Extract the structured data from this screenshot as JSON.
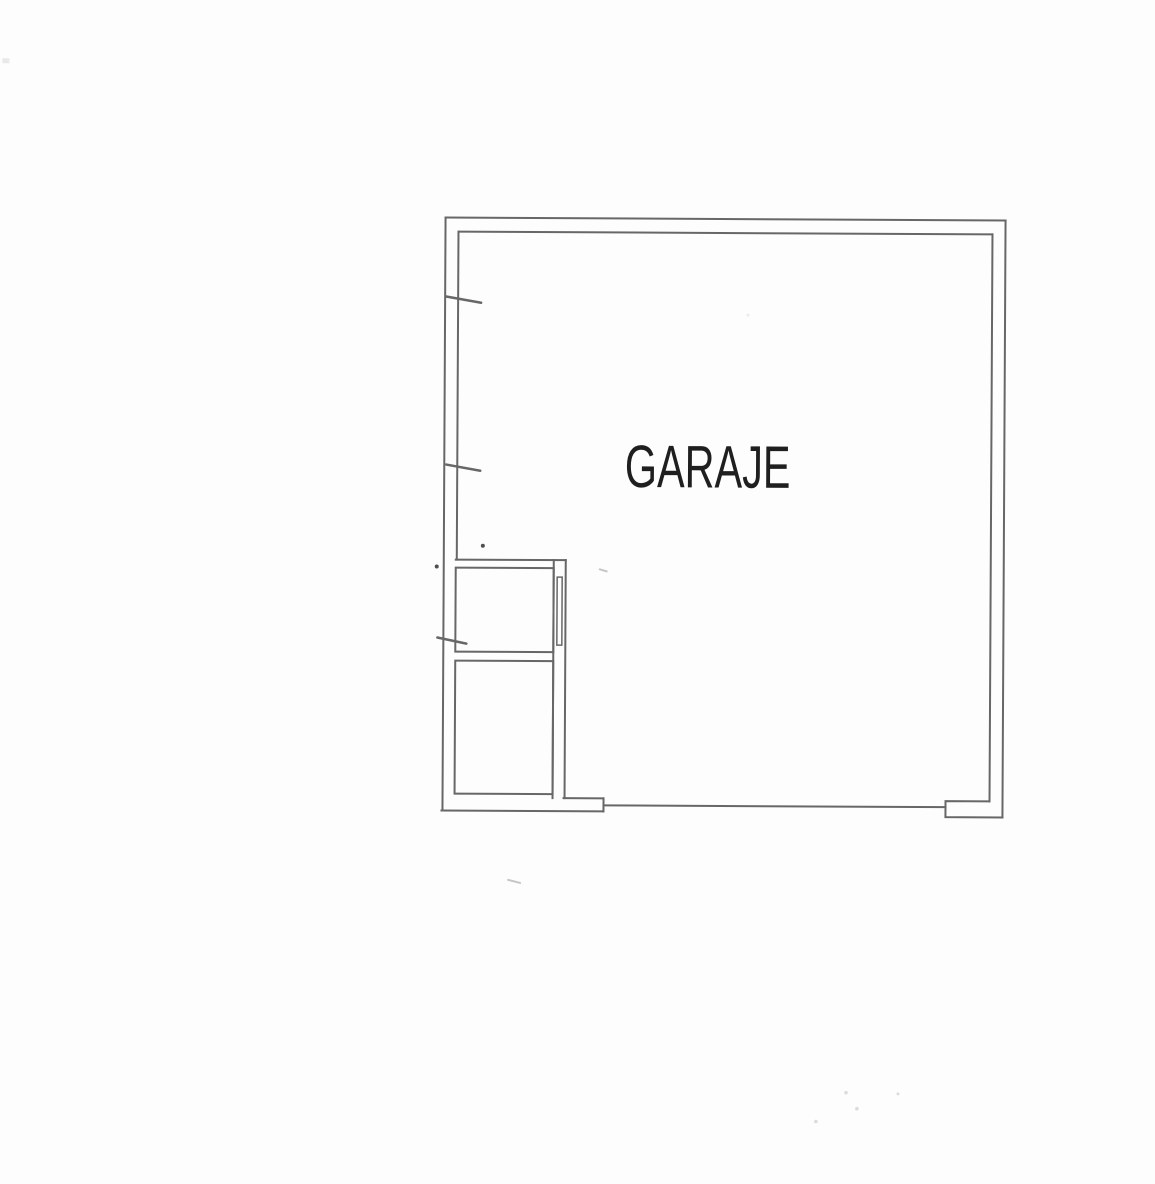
{
  "page": {
    "width": 1155,
    "height": 1184,
    "background": "#fdfdfd"
  },
  "colors": {
    "wall_line": "#676767",
    "label_text": "#1f1f1f",
    "pen_dot": "#4f4f4f",
    "faint_mark": "#c6c6c6",
    "scan_speck": "#dcdcdc"
  },
  "plan": {
    "room_label": "GARAJE",
    "elements": [
      "outer-wall",
      "inner-wall",
      "partition-wall",
      "upper-storage-room",
      "lower-storage-room",
      "door-leaf-in-partition",
      "garage-door-opening-bottom",
      "door-jamb-tab-bottom-right",
      "wall-tick-mark-1",
      "wall-tick-mark-2",
      "wall-tick-mark-3"
    ]
  }
}
